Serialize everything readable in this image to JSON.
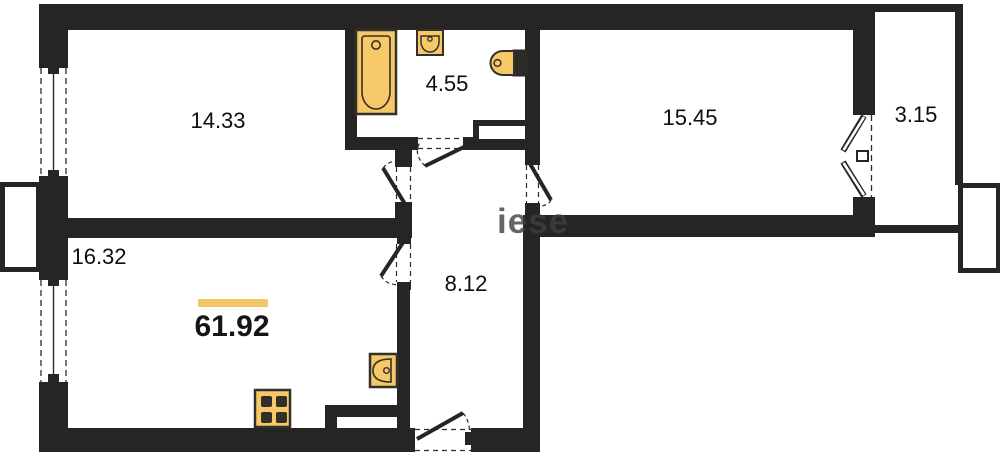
{
  "plan": {
    "total_area": "61.92",
    "watermark_text": "iese",
    "rooms": [
      {
        "name": "living-room",
        "area": "14.33"
      },
      {
        "name": "bathroom",
        "area": "4.55"
      },
      {
        "name": "bedroom",
        "area": "15.45"
      },
      {
        "name": "balcony",
        "area": "3.15"
      },
      {
        "name": "kitchen",
        "area": "16.32"
      },
      {
        "name": "hallway",
        "area": "8.12"
      }
    ],
    "fixtures": [
      "bathtub-icon",
      "bathroom-sink-icon",
      "toilet-icon",
      "kitchen-sink-icon",
      "stove-icon"
    ],
    "colors": {
      "wall": "#262524",
      "fixture_fill": "#f6c868",
      "fixture_stroke": "#32302b",
      "accent_bar": "#f2c864",
      "watermark": "#3f3f3f",
      "background": "#ffffff"
    }
  }
}
